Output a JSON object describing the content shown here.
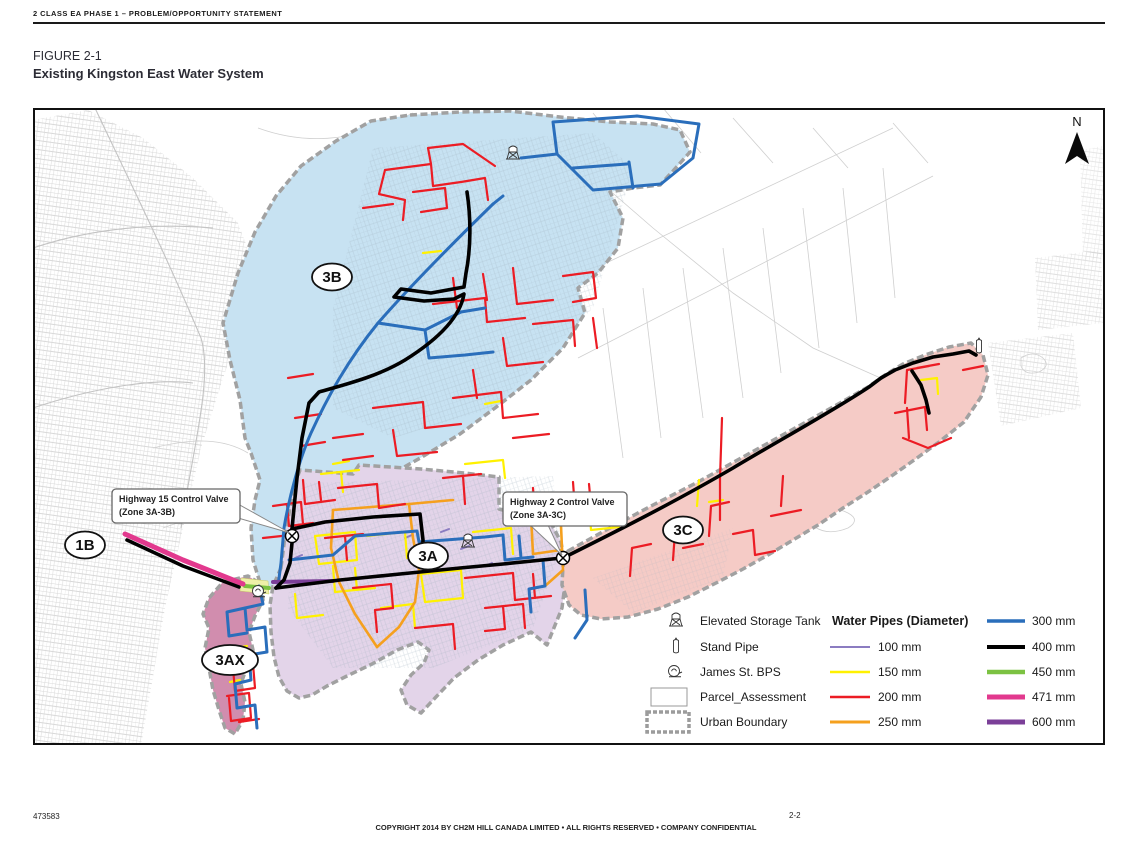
{
  "page": {
    "header_text": "2 CLASS EA PHASE 1 – PROBLEM/OPPORTUNITY STATEMENT",
    "figure_label": "FIGURE 2-1",
    "figure_title": "Existing Kingston East Water System",
    "footer": {
      "doc_number": "473583",
      "copyright": "COPYRIGHT 2014 BY CH2M HILL CANADA LIMITED • ALL RIGHTS RESERVED • COMPANY CONFIDENTIAL",
      "page_number": "2-2"
    }
  },
  "map": {
    "north_label": "N",
    "zone_labels": {
      "z1b": "1B",
      "z3b": "3B",
      "z3a": "3A",
      "z3c": "3C",
      "z3ax": "3AX"
    },
    "zone_colors": {
      "z3b": "#C7E2F2",
      "z3a": "#E3D4E9",
      "z3c": "#F5CBC6",
      "z3ax": "#D18DAE"
    },
    "callouts": [
      {
        "line1": "Highway 15 Control Valve",
        "line2": "(Zone 3A-3B)"
      },
      {
        "line1": "Highway 2 Control Valve",
        "line2": "(Zone 3A-3C)"
      }
    ]
  },
  "legend": {
    "symbols": [
      {
        "icon": "elevated-storage-tank-icon",
        "label": "Elevated Storage Tank"
      },
      {
        "icon": "stand-pipe-icon",
        "label": "Stand Pipe"
      },
      {
        "icon": "james-st-bps-icon",
        "label": "James St. BPS"
      },
      {
        "icon": "parcel-assessment-swatch",
        "label": "Parcel_Assessment"
      },
      {
        "icon": "urban-boundary-swatch",
        "label": "Urban Boundary"
      }
    ],
    "pipes_title": "Water Pipes (Diameter)",
    "pipes": [
      {
        "label": "100 mm",
        "color": "#8B7CC1"
      },
      {
        "label": "150 mm",
        "color": "#FFF100"
      },
      {
        "label": "200 mm",
        "color": "#EC1C24"
      },
      {
        "label": "250 mm",
        "color": "#F5A01E"
      },
      {
        "label": "300 mm",
        "color": "#2A6EBB"
      },
      {
        "label": "400 mm",
        "color": "#000000"
      },
      {
        "label": "450 mm",
        "color": "#7CC242"
      },
      {
        "label": "471 mm",
        "color": "#E2398E"
      },
      {
        "label": "600 mm",
        "color": "#7B3F98"
      }
    ]
  }
}
